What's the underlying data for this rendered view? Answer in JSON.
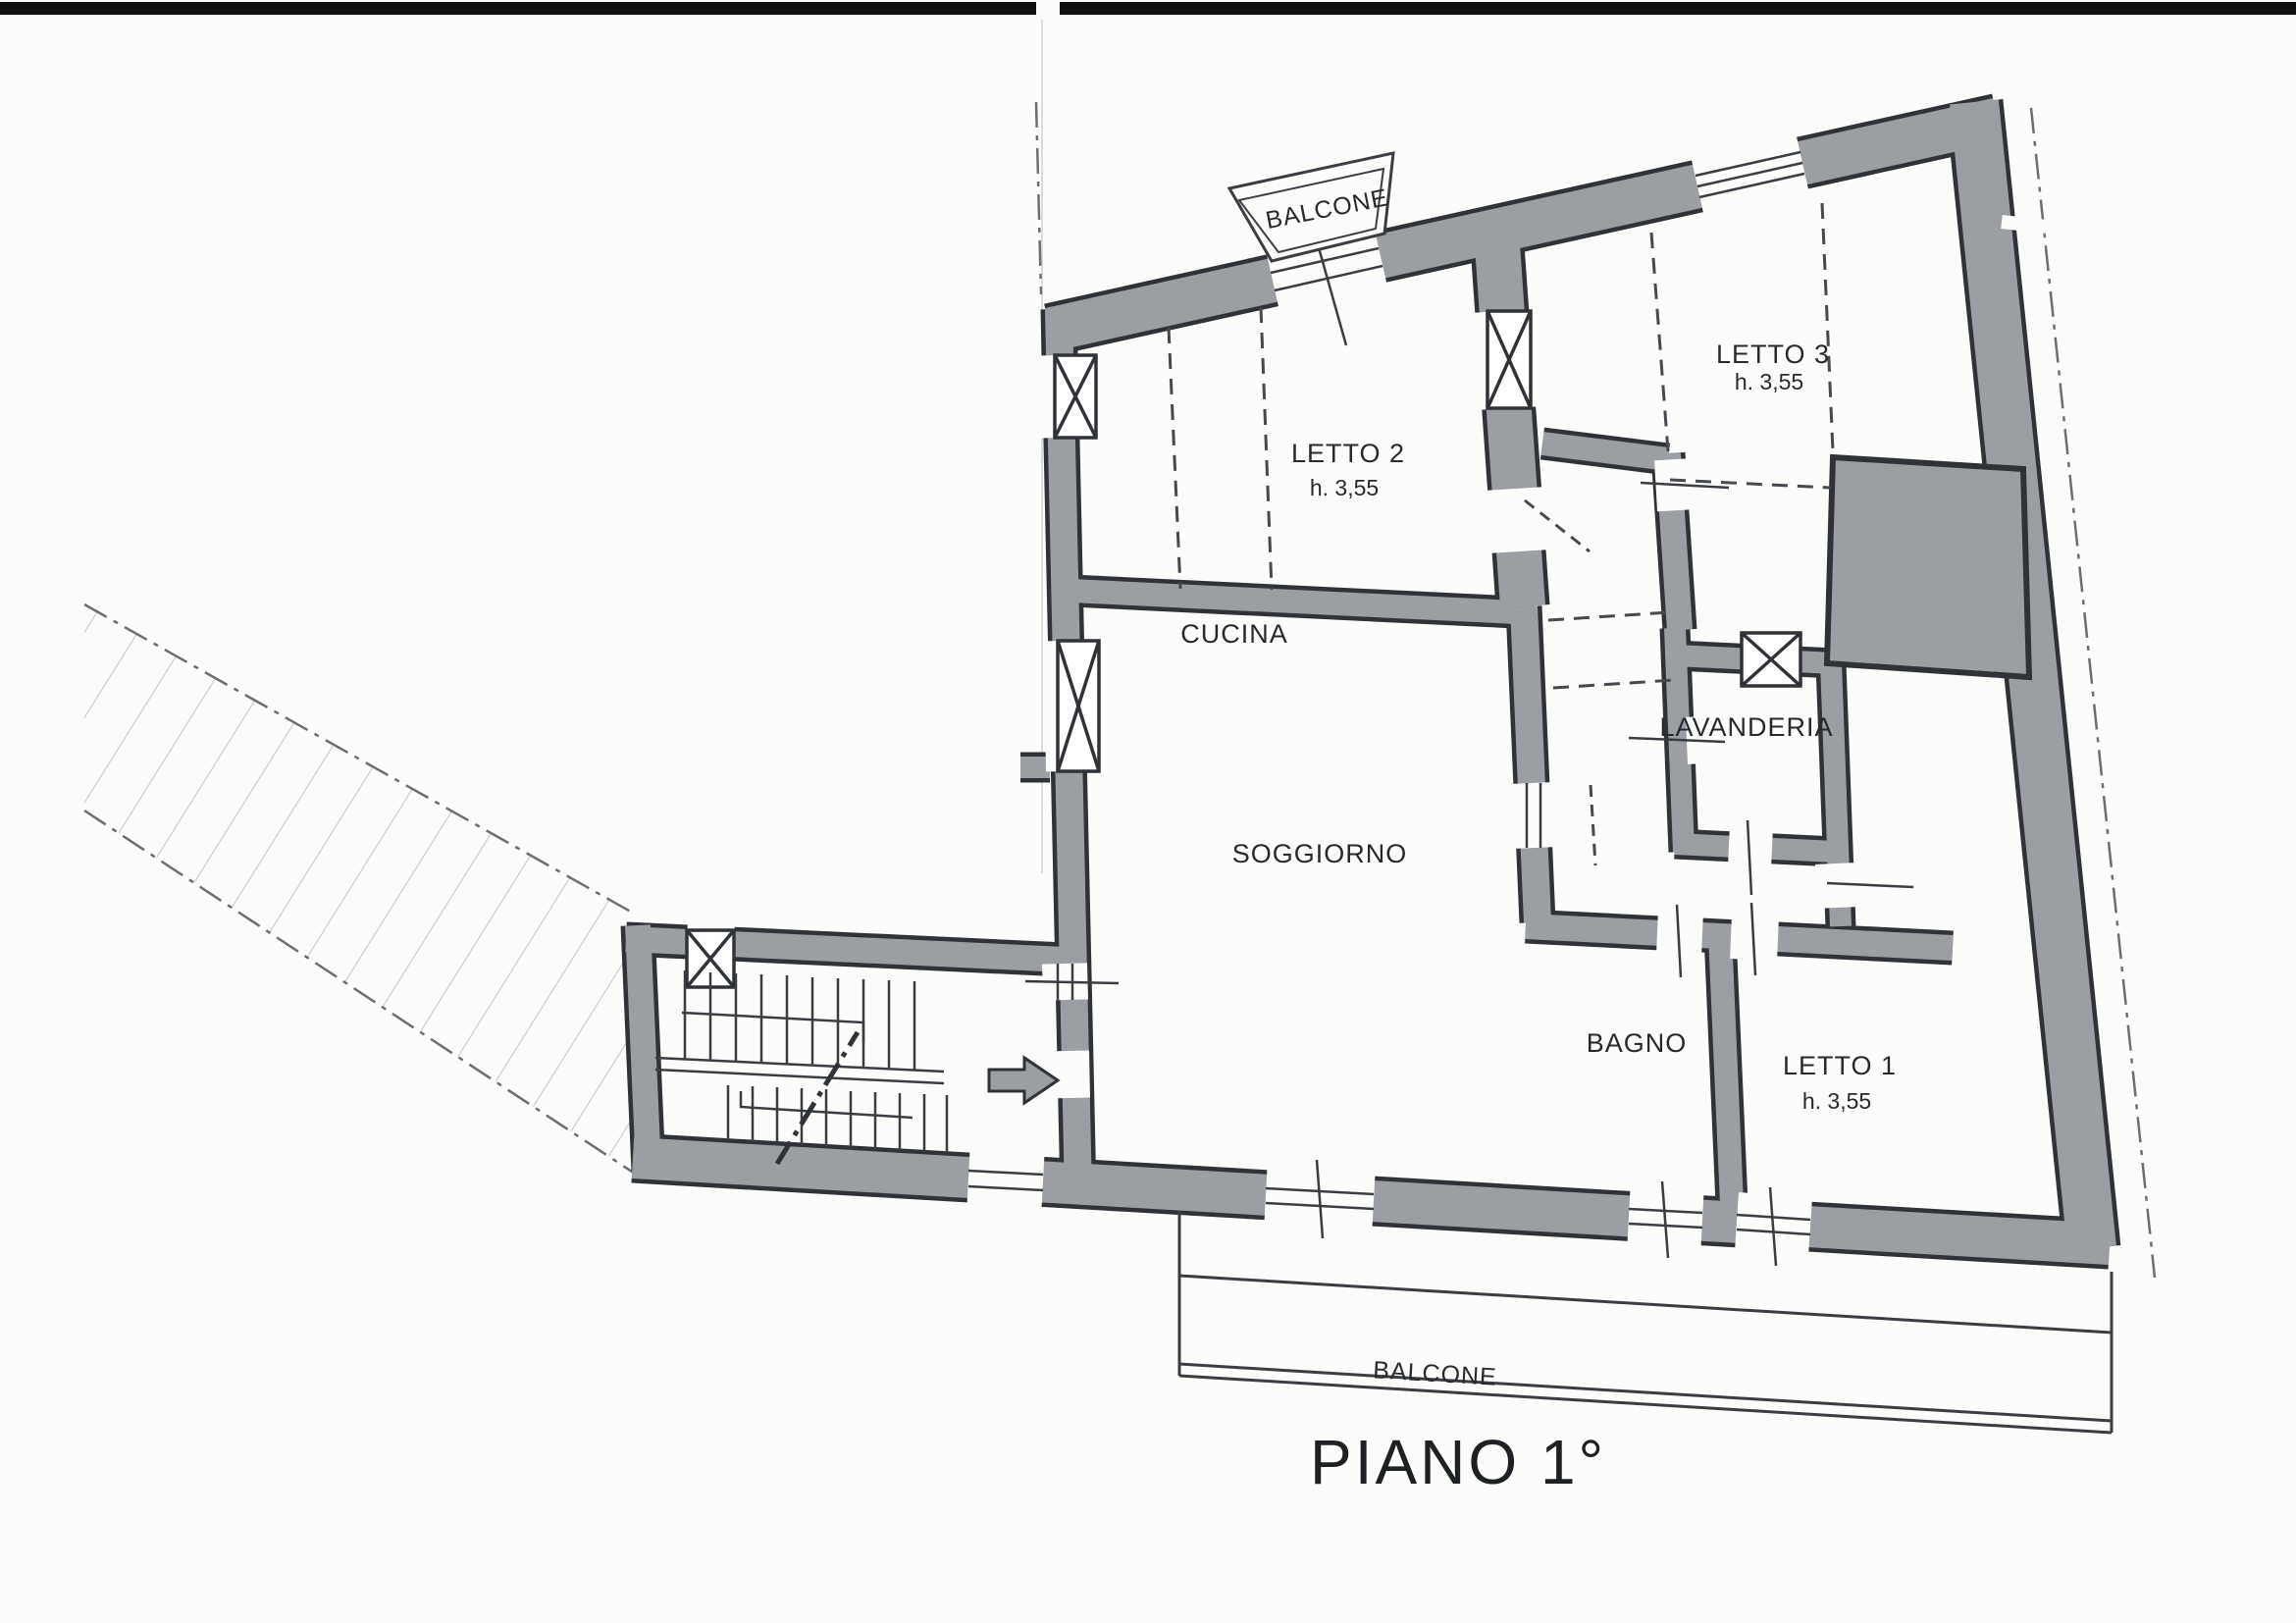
{
  "title": "PIANO 1°",
  "plan": {
    "rooms": {
      "letto2": {
        "label": "LETTO 2",
        "height": "h. 3,55"
      },
      "letto3": {
        "label": "LETTO 3",
        "height": "h. 3,55"
      },
      "letto1": {
        "label": "LETTO 1",
        "height": "h. 3,55"
      },
      "cucina": {
        "label": "CUCINA"
      },
      "soggiorno": {
        "label": "SOGGIORNO"
      },
      "lavanderia": {
        "label": "LAVANDERIA"
      },
      "bagno": {
        "label": "BAGNO"
      }
    },
    "balconies": {
      "top": {
        "label": "BALCONE"
      },
      "bottom": {
        "label": "BALCONE"
      }
    }
  },
  "colors": {
    "wall_fill": "#9b9fa4",
    "wall_outline": "#2f3237",
    "thin_line": "#3a3d42",
    "dashed_line": "#46494d",
    "paper": "#fcfcfb"
  }
}
